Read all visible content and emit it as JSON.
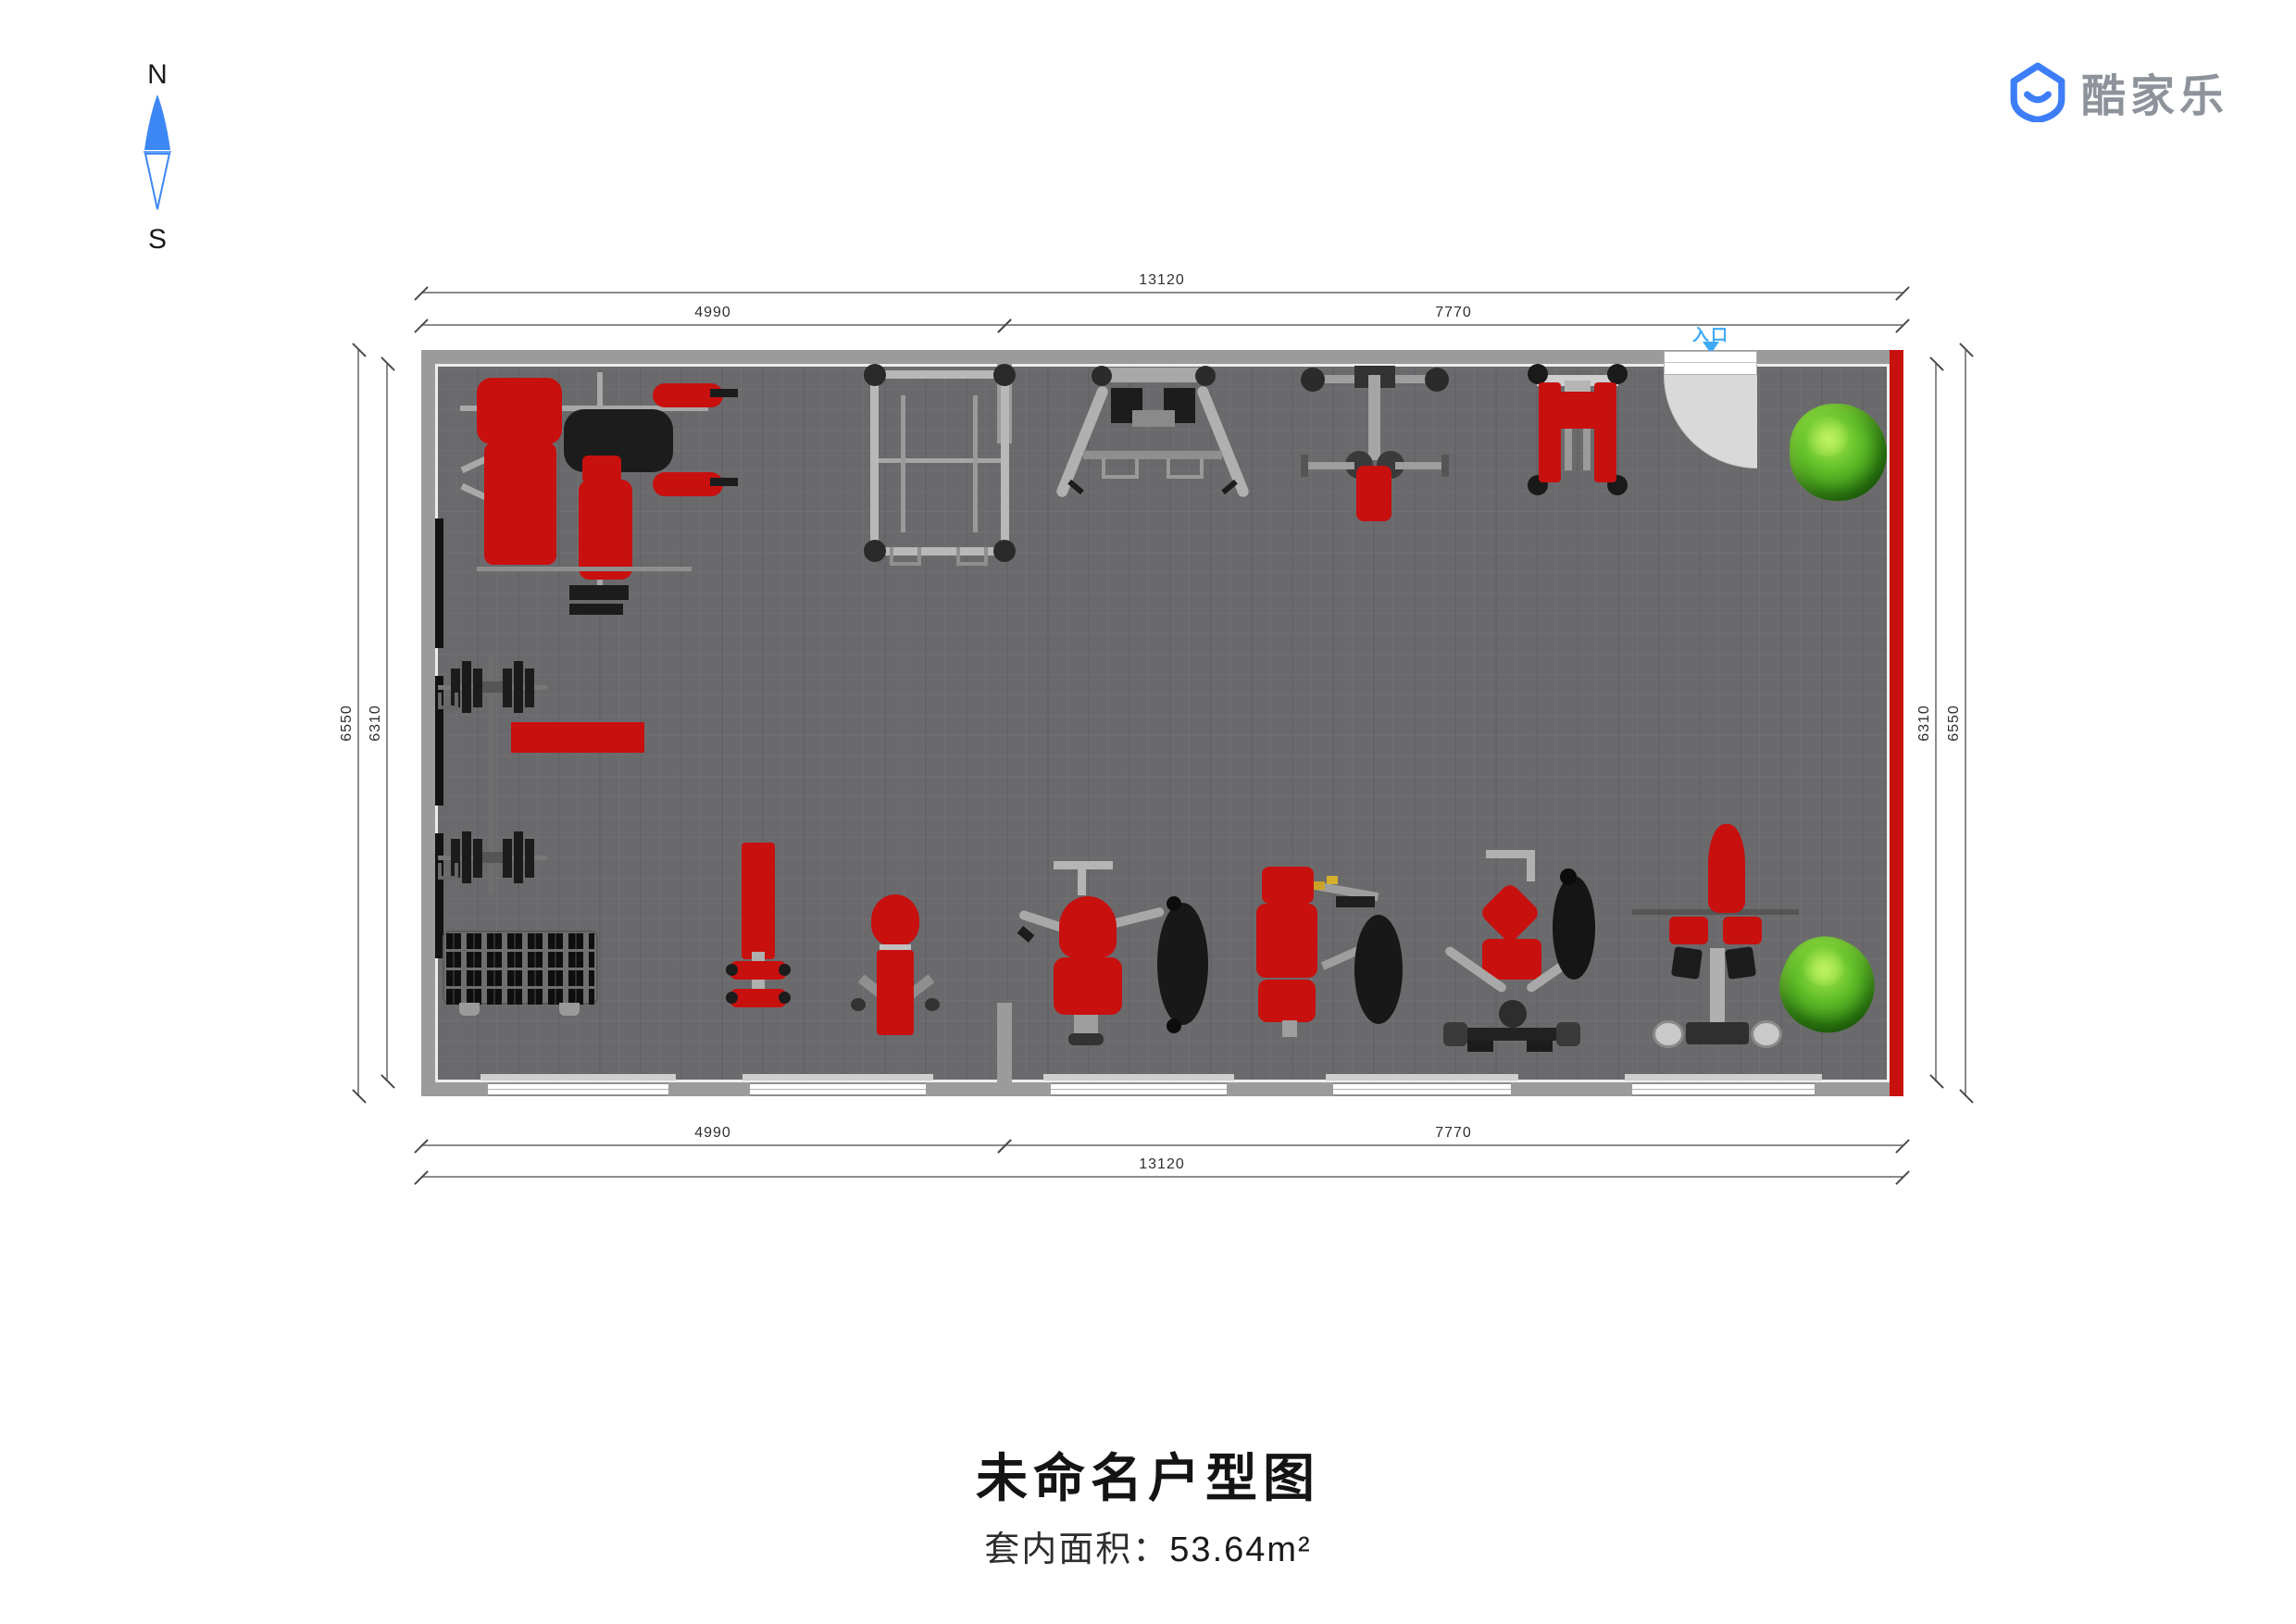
{
  "compass": {
    "north": "N",
    "south": "S"
  },
  "logo": {
    "brand": "酷家乐"
  },
  "plan": {
    "entrance_label": "入口",
    "dimensions": {
      "top_outer": "13120",
      "top_segment_left": "4990",
      "top_segment_right": "7770",
      "bottom_segment_left": "4990",
      "bottom_segment_right": "7770",
      "bottom_outer": "13120",
      "left_outer": "6550",
      "left_inner": "6310",
      "right_inner": "6310",
      "right_outer": "6550"
    },
    "equipment": [
      "multi-station-gym",
      "squat-rack",
      "a-frame-machine",
      "row-machine",
      "leg-press-machine",
      "barbell-station",
      "barbell-station",
      "flat-bench",
      "dumbbell-rack",
      "leg-curl-bench",
      "utility-bench",
      "seated-row-machine",
      "chest-press-machine",
      "pec-deck-machine",
      "lat-pulldown-machine",
      "potted-plant",
      "potted-plant"
    ]
  },
  "footer": {
    "title": "未命名户型图",
    "area_label": "套内面积：",
    "area_value": "53.64m²"
  },
  "colors": {
    "accent_blue": "#3d7ef8",
    "entrance_blue": "#3fa9f5",
    "equipment_red": "#c8100f",
    "wall_gray": "#9b9b9b",
    "floor_gray": "#6a6a6d",
    "plant_green": "#53b01e"
  }
}
